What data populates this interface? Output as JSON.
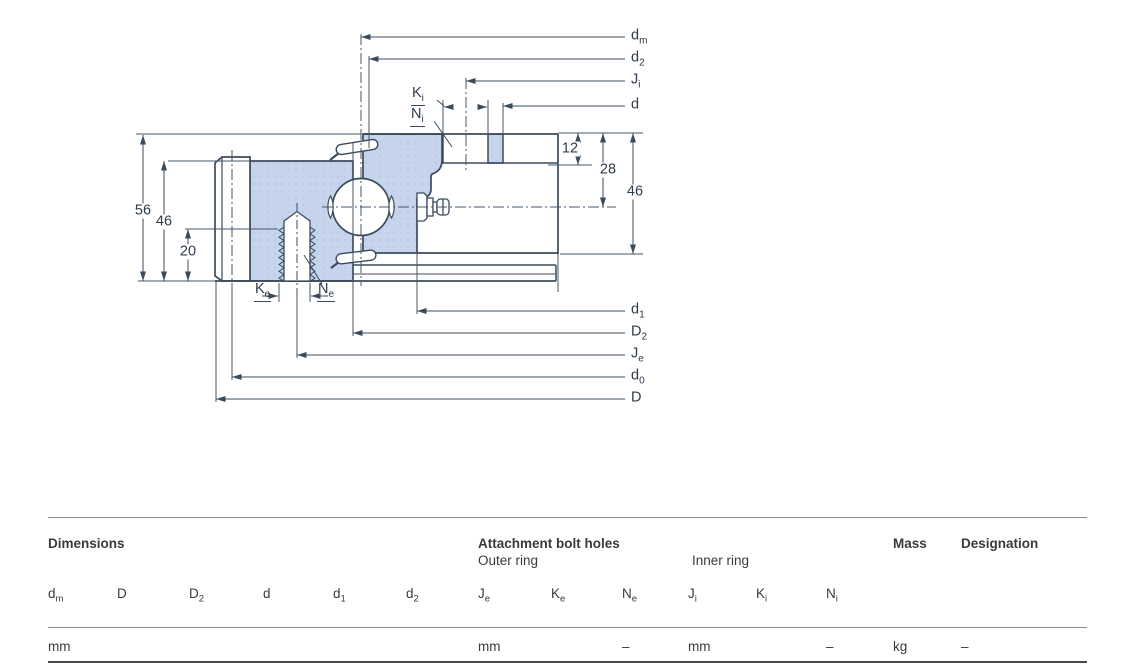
{
  "drawing": {
    "section_fill_color": "#c6d4ec",
    "line_color": "#3c4b5c",
    "text_color": "#2e3b4a",
    "values_left": [
      {
        "v": "56",
        "x": 143,
        "y": 211
      },
      {
        "v": "46",
        "x": 164,
        "y": 222
      },
      {
        "v": "20",
        "x": 188,
        "y": 252
      }
    ],
    "values_right": [
      {
        "v": "12",
        "x": 570,
        "y": 149
      },
      {
        "v": "28",
        "x": 608,
        "y": 170
      },
      {
        "v": "46",
        "x": 635,
        "y": 192
      }
    ],
    "dim_labels_top": [
      {
        "m": "d",
        "s": "m",
        "x": 631,
        "y": 37
      },
      {
        "m": "d",
        "s": "2",
        "x": 631,
        "y": 59
      },
      {
        "m": "J",
        "s": "i",
        "x": 631,
        "y": 81
      },
      {
        "m": "d",
        "s": "",
        "x": 631,
        "y": 106
      }
    ],
    "dim_labels_bottom": [
      {
        "m": "d",
        "s": "1",
        "x": 631,
        "y": 311
      },
      {
        "m": "D",
        "s": "2",
        "x": 631,
        "y": 333
      },
      {
        "m": "J",
        "s": "e",
        "x": 631,
        "y": 355
      },
      {
        "m": "d",
        "s": "0",
        "x": 631,
        "y": 377
      },
      {
        "m": "D",
        "s": "",
        "x": 631,
        "y": 399
      }
    ],
    "callouts": [
      {
        "m": "K",
        "s": "i",
        "x": 411,
        "y": 85
      },
      {
        "m": "N",
        "s": "i",
        "x": 410,
        "y": 106
      },
      {
        "m": "K",
        "s": "e",
        "x": 254,
        "y": 281
      },
      {
        "m": "N",
        "s": "e",
        "x": 317,
        "y": 281
      }
    ]
  },
  "table": {
    "headers": {
      "dimensions": "Dimensions",
      "attachment": "Attachment bolt holes",
      "outer_ring": "Outer ring",
      "inner_ring": "Inner ring",
      "mass": "Mass",
      "designation": "Designation"
    },
    "columns": [
      {
        "m": "d",
        "s": "m",
        "x": 48
      },
      {
        "m": "D",
        "s": "",
        "x": 117
      },
      {
        "m": "D",
        "s": "2",
        "x": 189
      },
      {
        "m": "d",
        "s": "",
        "x": 263
      },
      {
        "m": "d",
        "s": "1",
        "x": 333
      },
      {
        "m": "d",
        "s": "2",
        "x": 406
      },
      {
        "m": "J",
        "s": "e",
        "x": 478
      },
      {
        "m": "K",
        "s": "e",
        "x": 551
      },
      {
        "m": "N",
        "s": "e",
        "x": 622
      },
      {
        "m": "J",
        "s": "i",
        "x": 688
      },
      {
        "m": "K",
        "s": "i",
        "x": 756
      },
      {
        "m": "N",
        "s": "i",
        "x": 826
      }
    ],
    "units": [
      {
        "v": "mm",
        "x": 48
      },
      {
        "v": "mm",
        "x": 478
      },
      {
        "v": "–",
        "x": 622
      },
      {
        "v": "mm",
        "x": 688
      },
      {
        "v": "–",
        "x": 826
      },
      {
        "v": "kg",
        "x": 893
      },
      {
        "v": "–",
        "x": 961
      }
    ]
  }
}
